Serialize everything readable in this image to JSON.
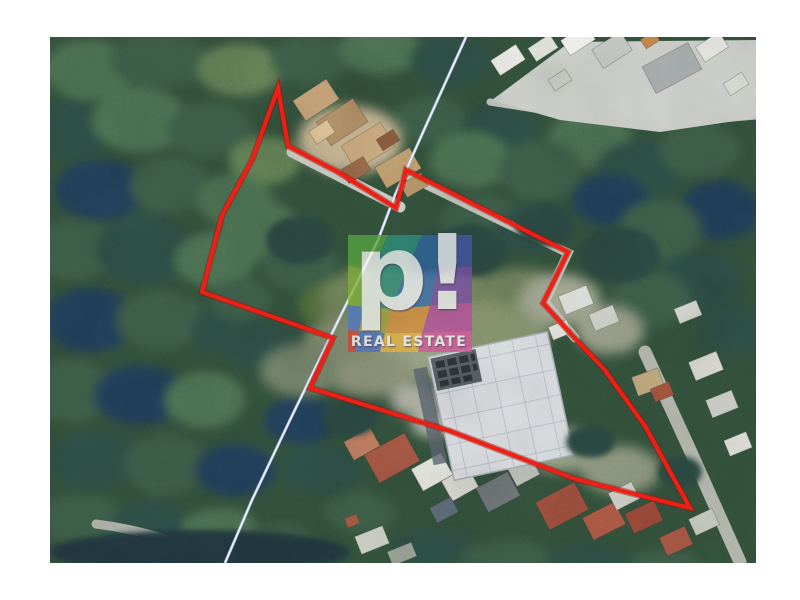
{
  "watermark": {
    "logo_text": "p!",
    "tagline": "REAL ESTATE",
    "text_color": "#fafbfc",
    "opacity": 0.74,
    "facet_colors": [
      "#57a33f",
      "#2f8f7e",
      "#31679e",
      "#4656a8",
      "#7fae3c",
      "#35907d",
      "#3b6fae",
      "#7a4fa8",
      "#4f79c4",
      "#a8a43c",
      "#d88f3b",
      "#b84d9e",
      "#cf4436",
      "#4f74c0",
      "#e2b33c",
      "#d4569a"
    ]
  },
  "boundary": {
    "color": "#ee2015",
    "under_color": "#9c100a",
    "width": 4,
    "under_width": 6.5,
    "points": "278,88 288,146 338,172 396,208 406,170 568,252 543,303 572,335 604,369 645,426 690,508 575,479 450,431 310,388 333,338 202,292 222,215 252,160"
  },
  "utility_line": {
    "color": "#eef2fb",
    "edge_color": "#aebbdd",
    "points": "466,37 424,130 395,195 378,240 337,323 290,420 252,500 225,563"
  }
}
